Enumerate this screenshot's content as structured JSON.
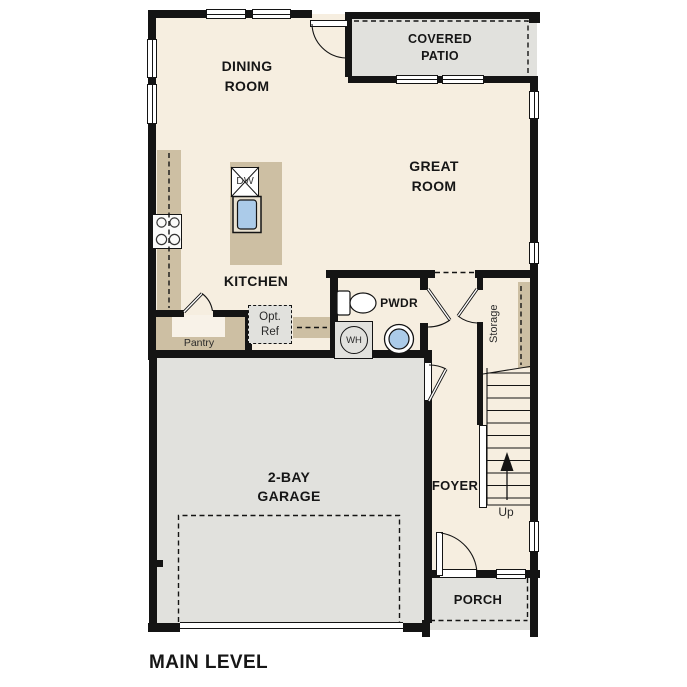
{
  "title": "MAIN LEVEL",
  "colors": {
    "wall": "#141414",
    "floor": "#f6eee0",
    "outdoor_grey": "#e1e1dd",
    "cabinet_tan": "#cdbfa3",
    "fixture_blue": "#abcbe9"
  },
  "rooms": {
    "dining": "DINING\nROOM",
    "covered_patio": "COVERED\nPATIO",
    "great": "GREAT\nROOM",
    "kitchen": "KITCHEN",
    "pwdr": "PWDR",
    "garage": "2-BAY\nGARAGE",
    "foyer": "FOYER",
    "porch": "PORCH"
  },
  "features": {
    "pantry": "Pantry",
    "opt_ref": "Opt.\nRef",
    "storage": "Storage",
    "up": "Up",
    "water_heater": "WH",
    "dishwasher": "DW"
  }
}
